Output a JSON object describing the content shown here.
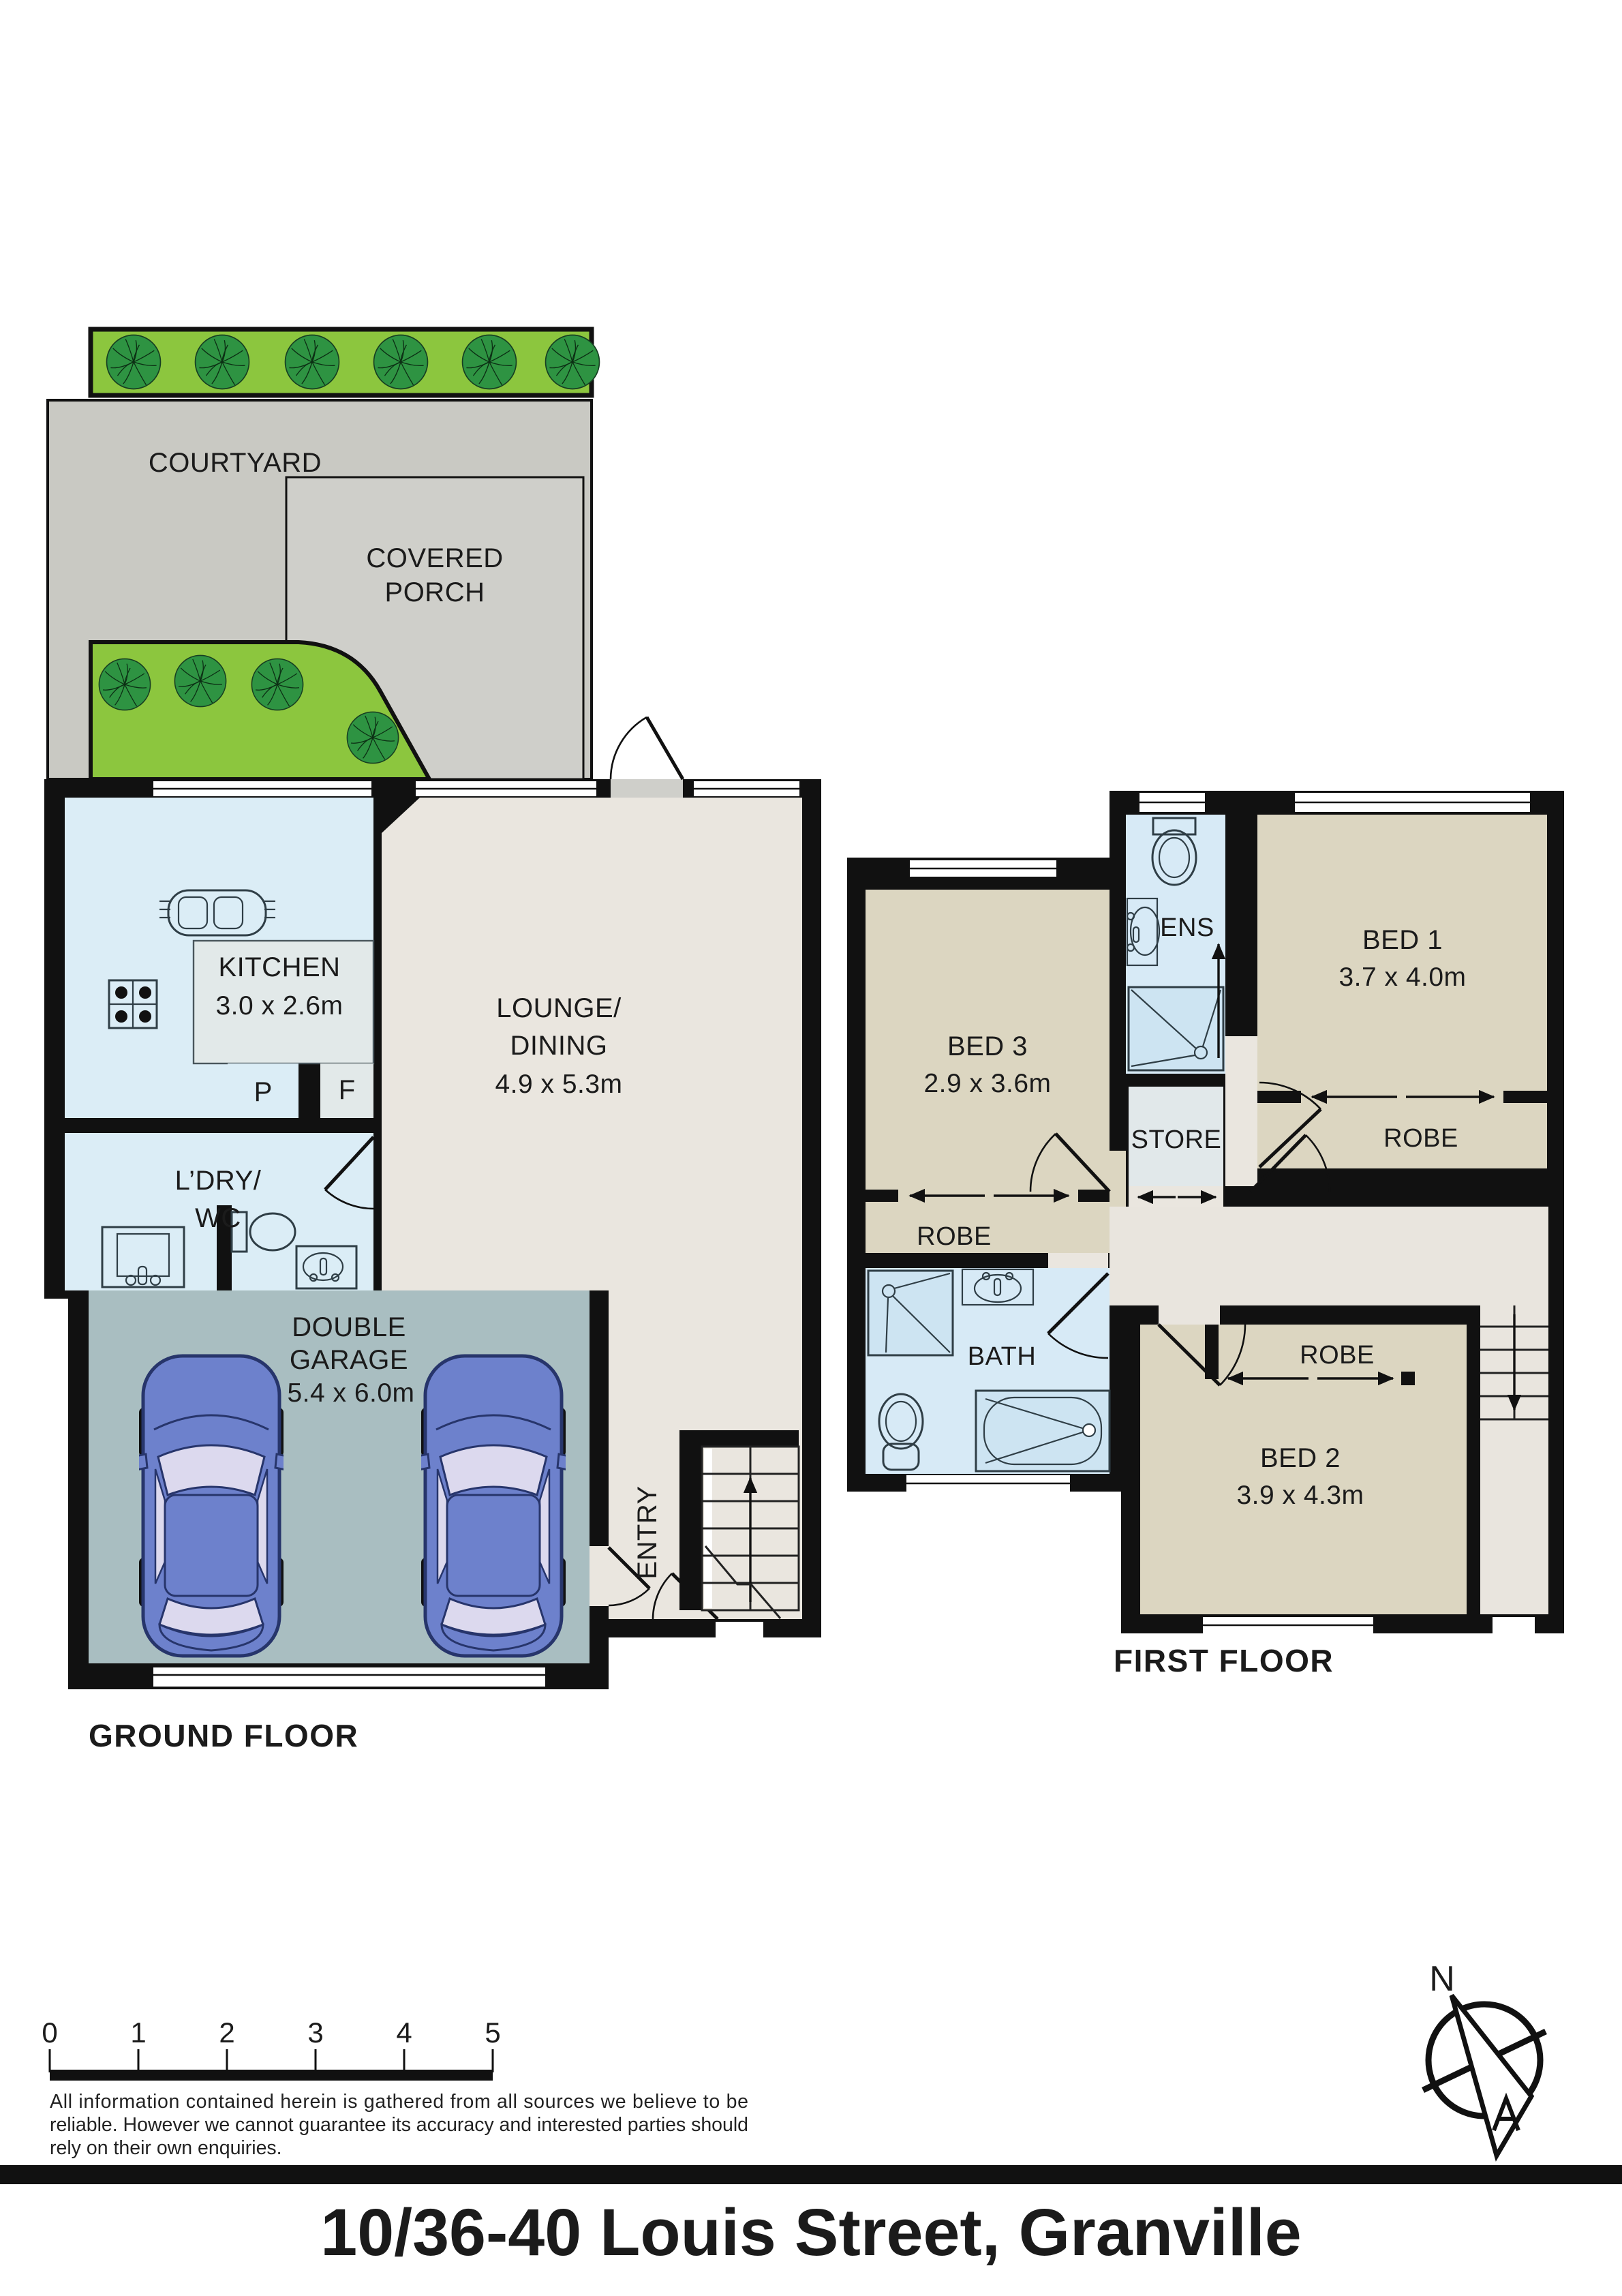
{
  "title": "10/36-40 Louis Street, Granville",
  "ground_floor": {
    "label": "GROUND FLOOR",
    "courtyard": "COURTYARD",
    "covered_porch_line1": "COVERED",
    "covered_porch_line2": "PORCH",
    "kitchen": {
      "name": "KITCHEN",
      "dims": "3.0 x 2.6m"
    },
    "lounge": {
      "name_line1": "LOUNGE/",
      "name_line2": "DINING",
      "dims": "4.9 x 5.3m"
    },
    "laundry": {
      "name_line1": "L’DRY/",
      "name_line2": "WC"
    },
    "pantry": "P",
    "fridge": "F",
    "garage": {
      "name_line1": "DOUBLE",
      "name_line2": "GARAGE",
      "dims": "5.4 x 6.0m"
    },
    "entry": "ENTRY"
  },
  "first_floor": {
    "label": "FIRST FLOOR",
    "bed1": {
      "name": "BED 1",
      "dims": "3.7 x 4.0m"
    },
    "bed2": {
      "name": "BED 2",
      "dims": "3.9 x 4.3m"
    },
    "bed3": {
      "name": "BED 3",
      "dims": "2.9 x 3.6m"
    },
    "ens": "ENS",
    "store": "STORE",
    "bath": "BATH",
    "robe_bed1": "ROBE",
    "robe_bed2": "ROBE",
    "robe_bed3": "ROBE"
  },
  "scale_bar": {
    "ticks": [
      "0",
      "1",
      "2",
      "3",
      "4",
      "5"
    ]
  },
  "disclaimer": {
    "line1": "All information contained herein is gathered from all sources we believe to be",
    "line2": "reliable. However we cannot guarantee its accuracy and interested parties should",
    "line3": "rely on their own enquiries."
  },
  "compass": {
    "north": "N"
  },
  "colors": {
    "grass": "#8CC63E",
    "tree": "#2E9342",
    "courtyard": "#C9C9C3",
    "porch": "#CFCFCA",
    "room_cream": "#EAE6DF",
    "room_beige": "#DCD6C1",
    "wet_blue": "#D7EAF6",
    "kitchen_blue": "#DBEDF6",
    "bench_gray": "#E2E9E9",
    "garage_gray": "#A9BEC1",
    "car_blue": "#6D81CC",
    "wall": "#111111"
  }
}
